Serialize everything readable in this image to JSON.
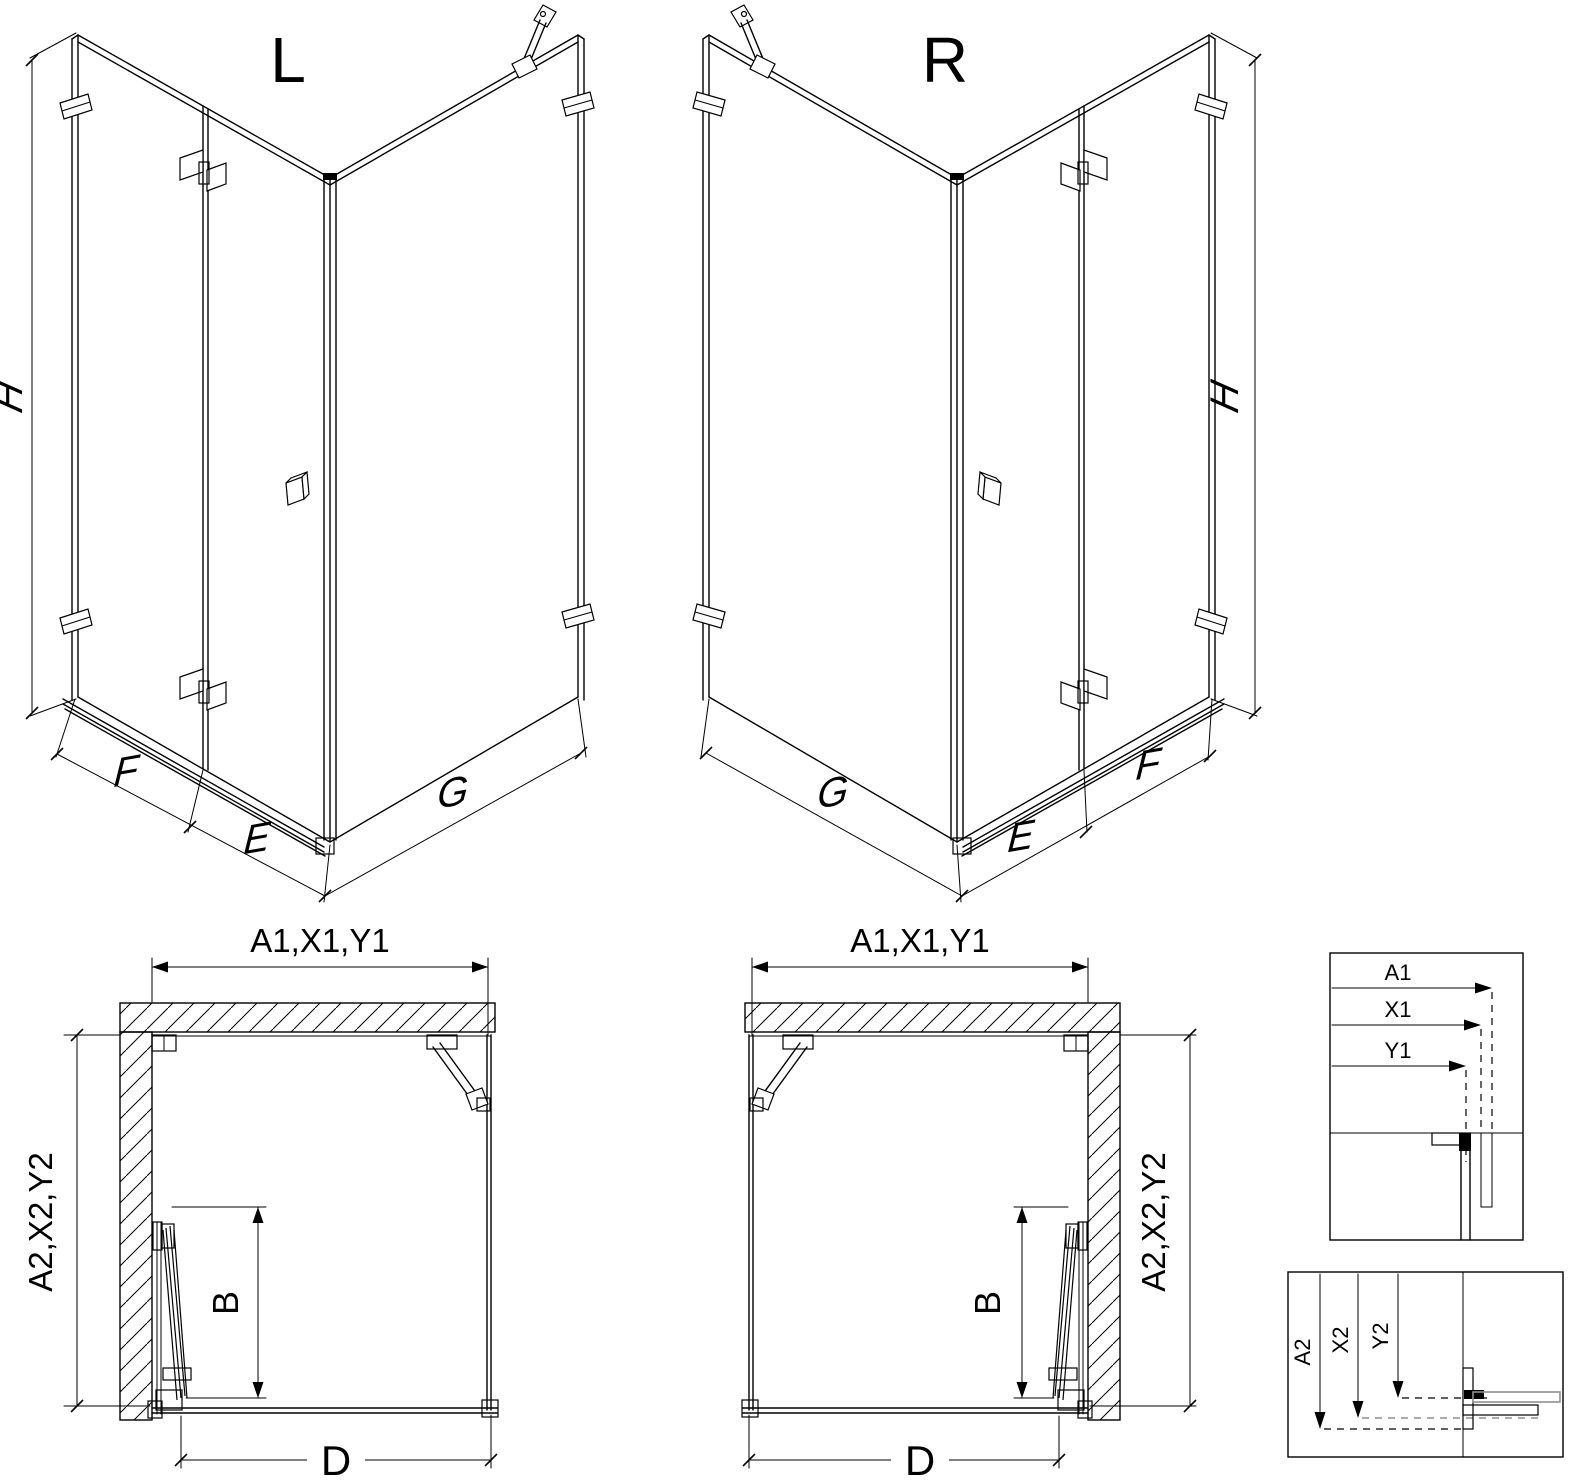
{
  "colors": {
    "line": "#000000",
    "gray": "#8f8f8f",
    "background": "#ffffff"
  },
  "iso_left": {
    "label": "L",
    "dim_height": "H",
    "dim_fixed": "F",
    "dim_door": "E",
    "dim_side": "G"
  },
  "iso_right": {
    "label": "R",
    "dim_height": "H",
    "dim_fixed": "F",
    "dim_door": "E",
    "dim_side": "G"
  },
  "plan_left": {
    "dim_top": "A1,X1,Y1",
    "dim_side": "A2,X2,Y2",
    "dim_door": "B",
    "dim_bottom": "D"
  },
  "plan_right": {
    "dim_top": "A1,X1,Y1",
    "dim_side": "A2,X2,Y2",
    "dim_door": "B",
    "dim_bottom": "D"
  },
  "detail_width": {
    "a1": "A1",
    "x1": "X1",
    "y1": "Y1"
  },
  "detail_depth": {
    "a2": "A2",
    "x2": "X2",
    "y2": "Y2"
  }
}
